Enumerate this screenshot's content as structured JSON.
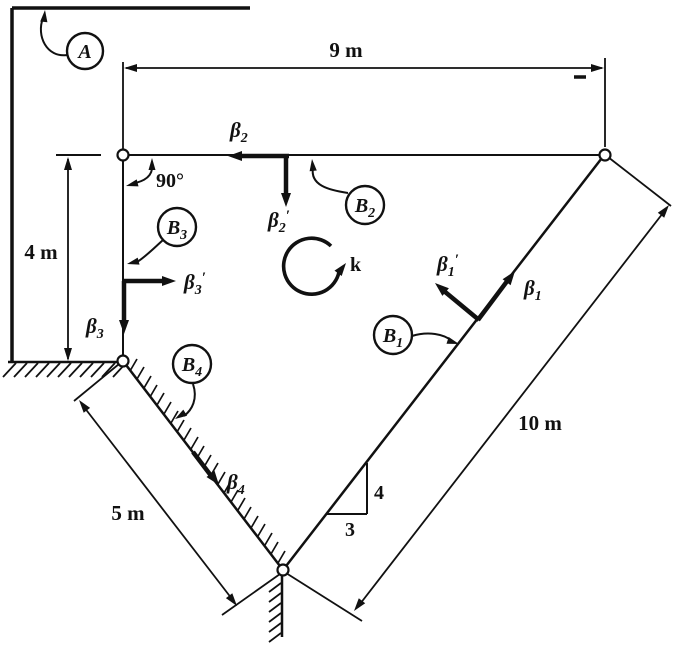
{
  "figure": {
    "bodies": {
      "A": {
        "main": "A"
      },
      "B1": {
        "main": "B",
        "sub": "1"
      },
      "B2": {
        "main": "B",
        "sub": "2"
      },
      "B3": {
        "main": "B",
        "sub": "3"
      },
      "B4": {
        "main": "B",
        "sub": "4"
      }
    },
    "vectors": {
      "beta1": {
        "main": "β",
        "sub": "1"
      },
      "beta1p": {
        "main": "β",
        "sub": "1",
        "prime": "′"
      },
      "beta2": {
        "main": "β",
        "sub": "2"
      },
      "beta2p": {
        "main": "β",
        "sub": "2",
        "prime": "′"
      },
      "beta3": {
        "main": "β",
        "sub": "3"
      },
      "beta3p": {
        "main": "β",
        "sub": "3",
        "prime": "′"
      },
      "beta4": {
        "main": "β",
        "sub": "4"
      },
      "k": "k"
    },
    "dimensions": {
      "top_span": "9 m",
      "left_height": "4 m",
      "incline_left": "5 m",
      "incline_right": "10 m"
    },
    "angle_label": "90°",
    "slope_triangle": {
      "rise": "4",
      "run": "3"
    },
    "colors": {
      "ink": "#111111",
      "paper": "#ffffff"
    }
  }
}
